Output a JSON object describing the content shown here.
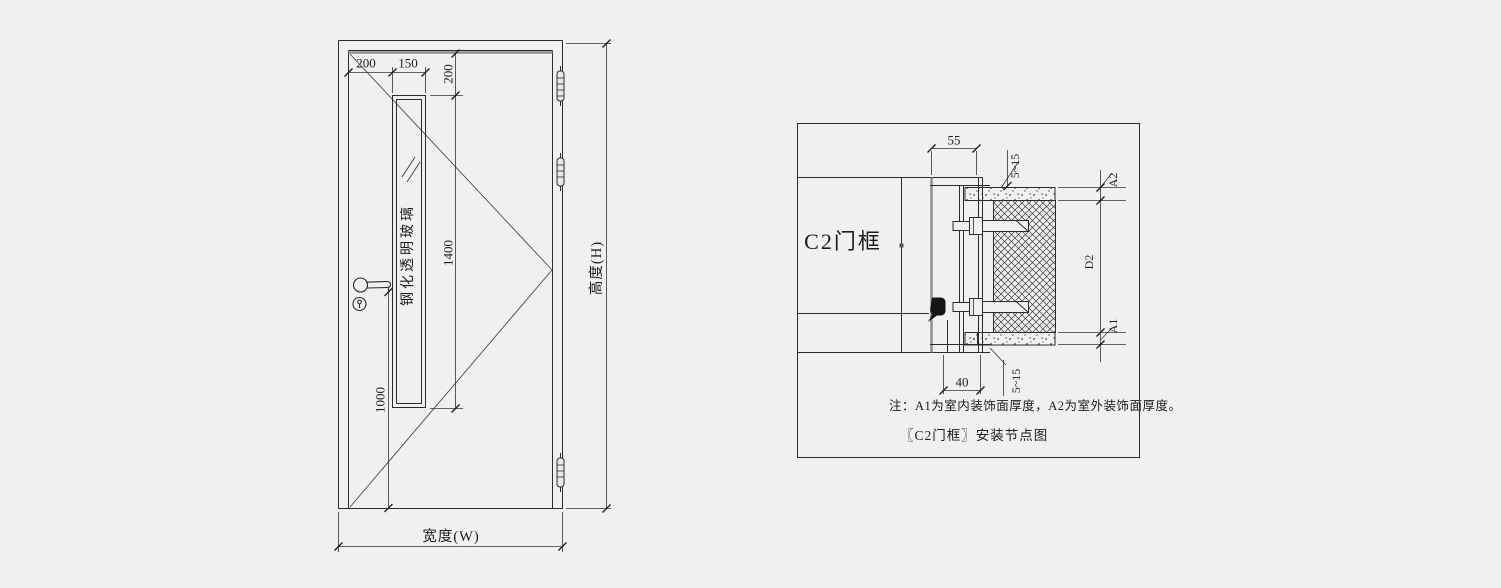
{
  "door_elevation": {
    "glass_label": "钢化透明玻璃",
    "width_label": "宽度(W)",
    "height_label": "高度(H)",
    "dims": {
      "left_margin": "200",
      "glass_width": "150",
      "top_margin": "200",
      "glass_height": "1400",
      "handle_height": "1000"
    }
  },
  "install_detail": {
    "frame_label": "C2门框",
    "dims": {
      "frame_depth": "55",
      "stop_width": "40",
      "gap_top": "5~15",
      "gap_bottom": "5~15",
      "outdoor_finish": "A2",
      "wall_thickness": "D2",
      "indoor_finish": "A1"
    },
    "note": "注：A1为室内装饰面厚度，A2为室外装饰面厚度。",
    "caption": "〖C2门框〗安装节点图"
  },
  "colors": {
    "background": "#f0f0ee",
    "line": "#2b2b2b",
    "thick_gray": "#8f8f8f",
    "seal_black": "#151515"
  }
}
